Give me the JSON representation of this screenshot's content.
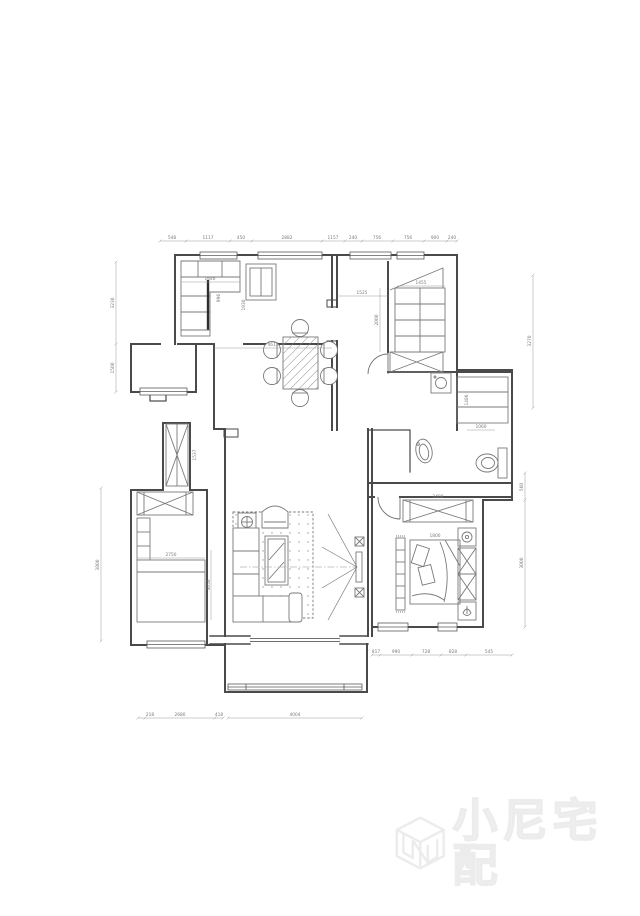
{
  "watermark": {
    "brand_text": "小尼宅配",
    "logo_name": "cube-n-logo",
    "color": "#efefef"
  },
  "palette": {
    "background": "#ffffff",
    "wall": "#4a4a4a",
    "furniture": "#7a7a7a",
    "dimension": "#9a9a9a",
    "axis": "#b5b5b5"
  },
  "dimensions": {
    "top": [
      "548",
      "1117",
      "450",
      "2882",
      "1157"
    ],
    "top_right": [
      "240",
      "756",
      "756",
      "900",
      "240"
    ],
    "left_kitchen": [
      "3230",
      "1500"
    ],
    "left_bedroom": [
      "3800"
    ],
    "right_upper": [
      "3270"
    ],
    "right_lower": [
      "560",
      "3000"
    ],
    "bottom_left": [
      "218",
      "2680",
      "418"
    ],
    "bottom_center": [
      "4004"
    ],
    "bottom_right": [
      "817",
      "990",
      "728",
      "828",
      "545"
    ],
    "interior": [
      "4611",
      "1525",
      "1646",
      "1930",
      "996",
      "1455",
      "2000",
      "1060",
      "1486",
      "1800",
      "2400",
      "3050",
      "2750",
      "1537"
    ]
  }
}
